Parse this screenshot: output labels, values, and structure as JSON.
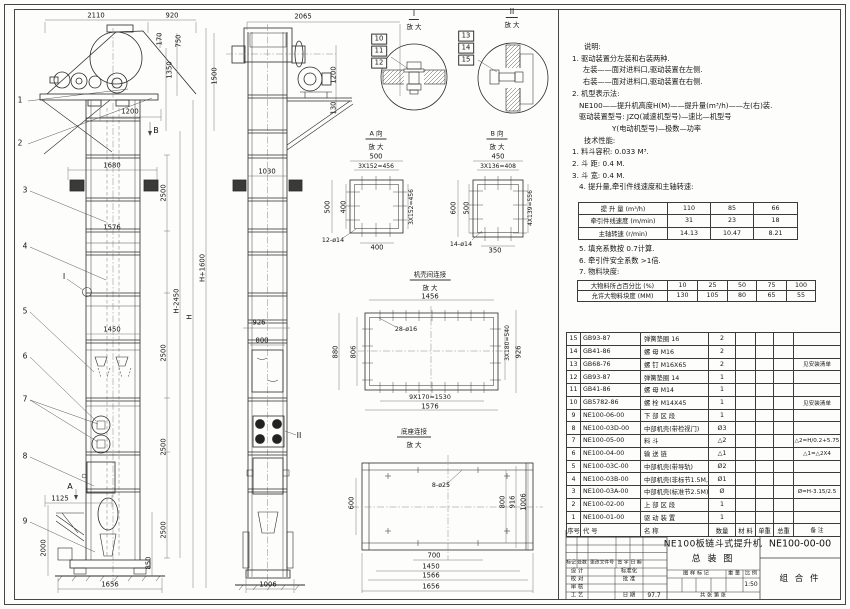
{
  "drawing_title": {
    "name": "NE100板链斗式提升机",
    "view": "总  装  图",
    "number": "NE100-00-00",
    "assembly": "组 合 件",
    "scale": "1:50",
    "date": "97.7"
  },
  "notes_block1": [
    {
      "t": "说明:",
      "i": 18
    },
    {
      "t": "1. 驱动装置分左装和右装两种.",
      "i": 6
    },
    {
      "t": "左装——面对进料口,驱动装置在左侧.",
      "i": 17
    },
    {
      "t": "右装——面对进料口,驱动装置在右侧.",
      "i": 17
    },
    {
      "t": "2. 机型表示法:",
      "i": 6
    },
    {
      "t": "NE100——提升机高度H(M)——提升量(m³/h)——左(右)装.",
      "i": 13
    },
    {
      "t": "驱动装置型号: JZQ(减速机型号)—速比—机型号",
      "i": 13
    },
    {
      "t": "Y(电动机型号)—极数—功率",
      "i": 46
    },
    {
      "t": "技术性能:",
      "i": 18
    },
    {
      "t": "1. 料斗容积: 0.033 M³.",
      "i": 6
    },
    {
      "t": "2. 斗  距: 0.4 M.",
      "i": 6
    },
    {
      "t": "3. 斗  宽: 0.4 M.",
      "i": 6
    },
    {
      "t": "4. 提升量,牵引件线速度和主轴转速:",
      "i": 13
    }
  ],
  "notes_block2": [
    {
      "t": "5. 填充系数按 0.7计算.",
      "i": 13
    },
    {
      "t": "6. 牵引件安全系数 >1倍.",
      "i": 13
    },
    {
      "t": "7. 物料块度:",
      "i": 13
    }
  ],
  "perf_table": [
    [
      "提 升 量  (m³/h)",
      "110",
      "85",
      "66"
    ],
    [
      "牵引件线速度 (m/min)",
      "31",
      "23",
      "18"
    ],
    [
      "主轴转速 (r/min)",
      "14.13",
      "10.47",
      "8.21"
    ]
  ],
  "lump_table": [
    [
      "大物料所占百分比 (%)",
      "10",
      "25",
      "50",
      "75",
      "100"
    ],
    [
      "允许大物料块度 (MM)",
      "130",
      "105",
      "80",
      "65",
      "55"
    ]
  ],
  "parts_table": [
    [
      "15",
      "GB93-87",
      "弹簧垫圈  16",
      "2",
      "",
      "",
      "",
      ""
    ],
    [
      "14",
      "GB41-86",
      "螺  母  M16",
      "2",
      "",
      "",
      "",
      ""
    ],
    [
      "13",
      "GB68-76",
      "螺  钉  M16X65",
      "2",
      "",
      "",
      "",
      "见安装清单"
    ],
    [
      "12",
      "GB93-87",
      "弹簧垫圈  14",
      "1",
      "",
      "",
      "",
      ""
    ],
    [
      "11",
      "GB41-86",
      "螺  母  M14",
      "1",
      "",
      "",
      "",
      ""
    ],
    [
      "10",
      "GB5782-86",
      "螺  栓  M14X45",
      "1",
      "",
      "",
      "",
      "见安装清单"
    ],
    [
      "9",
      "NE100-06-00",
      "下 部 区 段",
      "1",
      "",
      "",
      "",
      ""
    ],
    [
      "8",
      "NE100-03D-00",
      "中部机壳(带检视门)",
      "Ø3",
      "",
      "",
      "",
      ""
    ],
    [
      "7",
      "NE100-05-00",
      "料  斗",
      "△2",
      "",
      "",
      "",
      "△2=H/0.2+5.75"
    ],
    [
      "6",
      "NE100-04-00",
      "输 送 链",
      "△1",
      "",
      "",
      "",
      "△1=△2X4"
    ],
    [
      "5",
      "NE100-03C-00",
      "中部机壳(带导轨)",
      "Ø2",
      "",
      "",
      "",
      ""
    ],
    [
      "4",
      "NE100-03B-00",
      "中部机壳(非标节1.5M,1M)",
      "Ø1",
      "",
      "",
      "",
      ""
    ],
    [
      "3",
      "NE100-03A-00",
      "中部机壳(标准节2.5M)",
      "Ø",
      "",
      "",
      "",
      "Ø=H-3.15/2.5"
    ],
    [
      "2",
      "NE100-02-00",
      "上 部 区 段",
      "1",
      "",
      "",
      "",
      ""
    ],
    [
      "1",
      "NE100-01-00",
      "驱 动 装 置",
      "1",
      "",
      "",
      "",
      ""
    ],
    [
      "序号",
      "代  号",
      "名    称",
      "数量",
      "材 料",
      "单重",
      "总重",
      "备  注"
    ]
  ],
  "labels": [
    {
      "t": "2110",
      "x": 96,
      "y": 16
    },
    {
      "t": "920",
      "x": 172,
      "y": 16
    },
    {
      "t": "170",
      "x": 160,
      "y": 39,
      "r": 1
    },
    {
      "t": "750",
      "x": 179,
      "y": 41,
      "r": 1
    },
    {
      "t": "1350",
      "x": 170,
      "y": 70,
      "r": 1
    },
    {
      "t": "1500",
      "x": 215,
      "y": 76,
      "r": 1
    },
    {
      "t": "1200",
      "x": 130,
      "y": 112
    },
    {
      "t": "B",
      "x": 156,
      "y": 131,
      "s": 8
    },
    {
      "t": "1680",
      "x": 112,
      "y": 166
    },
    {
      "t": "2500",
      "x": 164,
      "y": 193,
      "r": 1
    },
    {
      "t": "1576",
      "x": 112,
      "y": 228
    },
    {
      "t": "H+1600",
      "x": 203,
      "y": 268,
      "r": 1
    },
    {
      "t": "H-2450",
      "x": 177,
      "y": 301,
      "r": 1
    },
    {
      "t": "H",
      "x": 190,
      "y": 317,
      "r": 1
    },
    {
      "t": "1450",
      "x": 112,
      "y": 330
    },
    {
      "t": "2500",
      "x": 164,
      "y": 353,
      "r": 1
    },
    {
      "t": "2500",
      "x": 164,
      "y": 447,
      "r": 1
    },
    {
      "t": "2500",
      "x": 164,
      "y": 530,
      "r": 1
    },
    {
      "t": "I",
      "x": 64,
      "y": 277,
      "s": 8
    },
    {
      "t": "A",
      "x": 70,
      "y": 487,
      "s": 8
    },
    {
      "t": "1125",
      "x": 60,
      "y": 499
    },
    {
      "t": "2000",
      "x": 44,
      "y": 548,
      "r": 1
    },
    {
      "t": "850",
      "x": 149,
      "y": 563,
      "r": 1
    },
    {
      "t": "1656",
      "x": 110,
      "y": 585
    },
    {
      "t": "1",
      "x": 20,
      "y": 100,
      "s": 7.5,
      "n": "balloon-1"
    },
    {
      "t": "2",
      "x": 20,
      "y": 143,
      "s": 7.5,
      "n": "balloon-2"
    },
    {
      "t": "3",
      "x": 25,
      "y": 190,
      "s": 7.5,
      "n": "balloon-3"
    },
    {
      "t": "4",
      "x": 25,
      "y": 246,
      "s": 7.5,
      "n": "balloon-4"
    },
    {
      "t": "5",
      "x": 25,
      "y": 311,
      "s": 7.5,
      "n": "balloon-5"
    },
    {
      "t": "6",
      "x": 25,
      "y": 356,
      "s": 7.5,
      "n": "balloon-6"
    },
    {
      "t": "7",
      "x": 25,
      "y": 399,
      "s": 7.5,
      "n": "balloon-7"
    },
    {
      "t": "8",
      "x": 25,
      "y": 456,
      "s": 7.5,
      "n": "balloon-8"
    },
    {
      "t": "9",
      "x": 25,
      "y": 521,
      "s": 7.5,
      "n": "balloon-9"
    },
    {
      "t": "2065",
      "x": 303,
      "y": 17
    },
    {
      "t": "1200",
      "x": 334,
      "y": 75,
      "r": 1
    },
    {
      "t": "130",
      "x": 334,
      "y": 108,
      "r": 1
    },
    {
      "t": "1030",
      "x": 267,
      "y": 172
    },
    {
      "t": "926",
      "x": 259,
      "y": 323
    },
    {
      "t": "800",
      "x": 262,
      "y": 341
    },
    {
      "t": "II",
      "x": 299,
      "y": 436,
      "s": 8
    },
    {
      "t": "1006",
      "x": 268,
      "y": 585
    },
    {
      "t": "I",
      "x": 414,
      "y": 15,
      "s": 7.5,
      "u": 1,
      "n": "detail-i-title"
    },
    {
      "t": "放 大",
      "x": 414,
      "y": 27,
      "s": 6.5
    },
    {
      "t": "II",
      "x": 512,
      "y": 13,
      "s": 7.5,
      "u": 1,
      "n": "detail-ii-title"
    },
    {
      "t": "放 大",
      "x": 512,
      "y": 25,
      "s": 6.5
    },
    {
      "t": "10",
      "x": 379,
      "y": 39,
      "b": 1
    },
    {
      "t": "11",
      "x": 379,
      "y": 51,
      "b": 1
    },
    {
      "t": "12",
      "x": 379,
      "y": 63,
      "b": 1
    },
    {
      "t": "13",
      "x": 466,
      "y": 36,
      "b": 1
    },
    {
      "t": "14",
      "x": 466,
      "y": 48,
      "b": 1
    },
    {
      "t": "15",
      "x": 466,
      "y": 60,
      "b": 1
    },
    {
      "t": "A 向",
      "x": 376,
      "y": 135,
      "s": 6.5,
      "u": 1,
      "n": "section-a-title"
    },
    {
      "t": "放 大",
      "x": 376,
      "y": 147,
      "s": 6.5
    },
    {
      "t": "500",
      "x": 376,
      "y": 157
    },
    {
      "t": "3X152=456",
      "x": 376,
      "y": 167,
      "s": 6
    },
    {
      "t": "500",
      "x": 328,
      "y": 207,
      "r": 1
    },
    {
      "t": "400",
      "x": 344,
      "y": 207,
      "r": 1
    },
    {
      "t": "3X152=456",
      "x": 412,
      "y": 207,
      "r": 1,
      "s": 6
    },
    {
      "t": "12-ø14",
      "x": 333,
      "y": 241,
      "s": 6.3
    },
    {
      "t": "400",
      "x": 377,
      "y": 248
    },
    {
      "t": "B 向",
      "x": 497,
      "y": 135,
      "s": 6.5,
      "u": 1,
      "n": "section-b-title"
    },
    {
      "t": "放 大",
      "x": 497,
      "y": 147,
      "s": 6.5
    },
    {
      "t": "450",
      "x": 498,
      "y": 157
    },
    {
      "t": "3X136=408",
      "x": 498,
      "y": 167,
      "s": 6
    },
    {
      "t": "600",
      "x": 454,
      "y": 208,
      "r": 1
    },
    {
      "t": "500",
      "x": 467,
      "y": 208,
      "r": 1
    },
    {
      "t": "4X139=556",
      "x": 531,
      "y": 208,
      "r": 1,
      "s": 6
    },
    {
      "t": "14-ø14",
      "x": 461,
      "y": 245,
      "s": 6.3
    },
    {
      "t": "350",
      "x": 495,
      "y": 251
    },
    {
      "t": "机壳间连接",
      "x": 430,
      "y": 276,
      "s": 6.5,
      "u": 1,
      "n": "casing-joint-title"
    },
    {
      "t": "放 大",
      "x": 430,
      "y": 288,
      "s": 6.5
    },
    {
      "t": "1456",
      "x": 430,
      "y": 297
    },
    {
      "t": "28-ø16",
      "x": 406,
      "y": 330,
      "s": 6.3
    },
    {
      "t": "880",
      "x": 336,
      "y": 352,
      "r": 1
    },
    {
      "t": "806",
      "x": 354,
      "y": 352,
      "r": 1
    },
    {
      "t": "3X180=540",
      "x": 508,
      "y": 343,
      "r": 1,
      "s": 6
    },
    {
      "t": "926",
      "x": 519,
      "y": 352,
      "r": 1
    },
    {
      "t": "9X170=1530",
      "x": 430,
      "y": 398,
      "s": 6.3
    },
    {
      "t": "1576",
      "x": 430,
      "y": 407
    },
    {
      "t": "底座连接",
      "x": 414,
      "y": 433,
      "s": 6.5,
      "u": 1,
      "n": "base-joint-title"
    },
    {
      "t": "放 大",
      "x": 414,
      "y": 445,
      "s": 6.5
    },
    {
      "t": "8-ø25",
      "x": 441,
      "y": 486,
      "s": 6.3
    },
    {
      "t": "600",
      "x": 352,
      "y": 503,
      "r": 1
    },
    {
      "t": "800",
      "x": 503,
      "y": 502,
      "r": 1
    },
    {
      "t": "916",
      "x": 513,
      "y": 502,
      "r": 1
    },
    {
      "t": "1006",
      "x": 524,
      "y": 502,
      "r": 1
    },
    {
      "t": "700",
      "x": 434,
      "y": 556
    },
    {
      "t": "1450",
      "x": 431,
      "y": 567
    },
    {
      "t": "1566",
      "x": 431,
      "y": 576
    },
    {
      "t": "1656",
      "x": 431,
      "y": 587
    },
    {
      "t": "标记",
      "x": 571,
      "y": 564,
      "s": 4.8
    },
    {
      "t": "处数",
      "x": 582,
      "y": 564,
      "s": 4.8
    },
    {
      "t": "更改文件号",
      "x": 602,
      "y": 564,
      "s": 4.8
    },
    {
      "t": "签 字",
      "x": 623,
      "y": 564,
      "s": 4.8
    },
    {
      "t": "日 期",
      "x": 636,
      "y": 564,
      "s": 4.8
    },
    {
      "t": "设 计",
      "x": 577,
      "y": 572,
      "s": 5.4
    },
    {
      "t": "标准化",
      "x": 629,
      "y": 572,
      "s": 5.4
    },
    {
      "t": "校 对",
      "x": 577,
      "y": 580,
      "s": 5.4
    },
    {
      "t": "批 准",
      "x": 629,
      "y": 580,
      "s": 5.4
    },
    {
      "t": "审 核",
      "x": 577,
      "y": 588,
      "s": 5.4
    },
    {
      "t": "工 艺",
      "x": 577,
      "y": 595.5,
      "s": 5.4
    },
    {
      "t": "日 期",
      "x": 629,
      "y": 595.5,
      "s": 5.4
    },
    {
      "t": "97.7",
      "x": 654,
      "y": 595.5,
      "s": 6,
      "n": "title-block-date"
    },
    {
      "t": "图 样 标 记",
      "x": 696,
      "y": 574,
      "s": 5.2
    },
    {
      "t": "重 量",
      "x": 734,
      "y": 574,
      "s": 5.2
    },
    {
      "t": "比 例",
      "x": 751,
      "y": 574,
      "s": 5.2
    },
    {
      "t": "1:50",
      "x": 751,
      "y": 585,
      "s": 6,
      "n": "drawing-scale"
    },
    {
      "t": "共   张  第   张",
      "x": 713,
      "y": 595.5,
      "s": 5.2
    }
  ]
}
